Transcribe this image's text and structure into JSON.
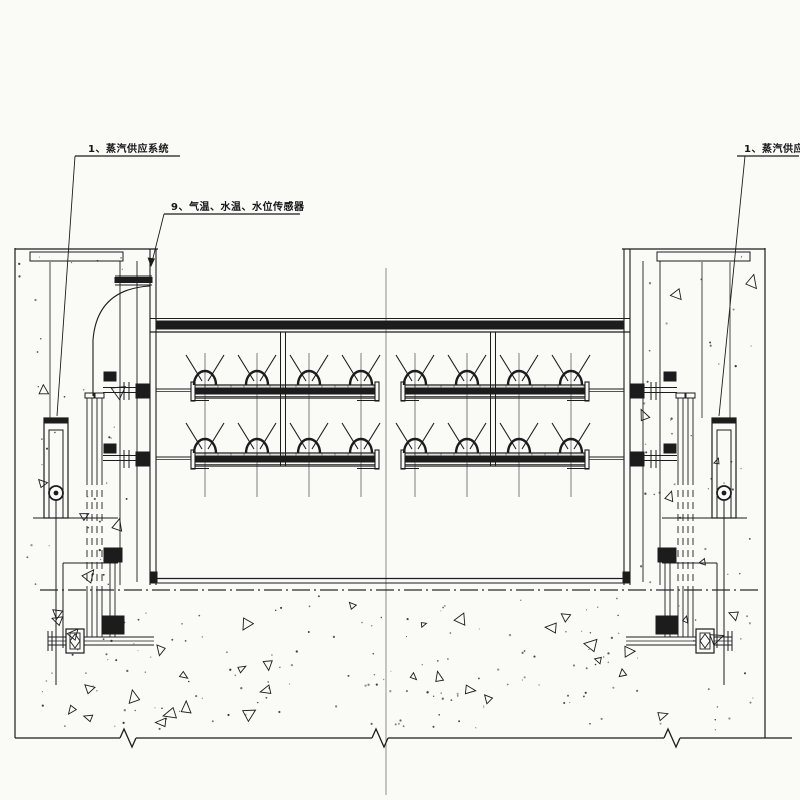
{
  "drawing": {
    "title": "steam-spray-system-elevation",
    "background_color": "#fafaf6",
    "line_color": "#1c1c1c",
    "centerline_color": "#808080"
  },
  "callouts": {
    "left_steam_supply": "1、蒸汽供应系统",
    "sensors": "9、气温、水温、水位传感器",
    "right_steam_supply": "1、蒸汽供应系统"
  }
}
